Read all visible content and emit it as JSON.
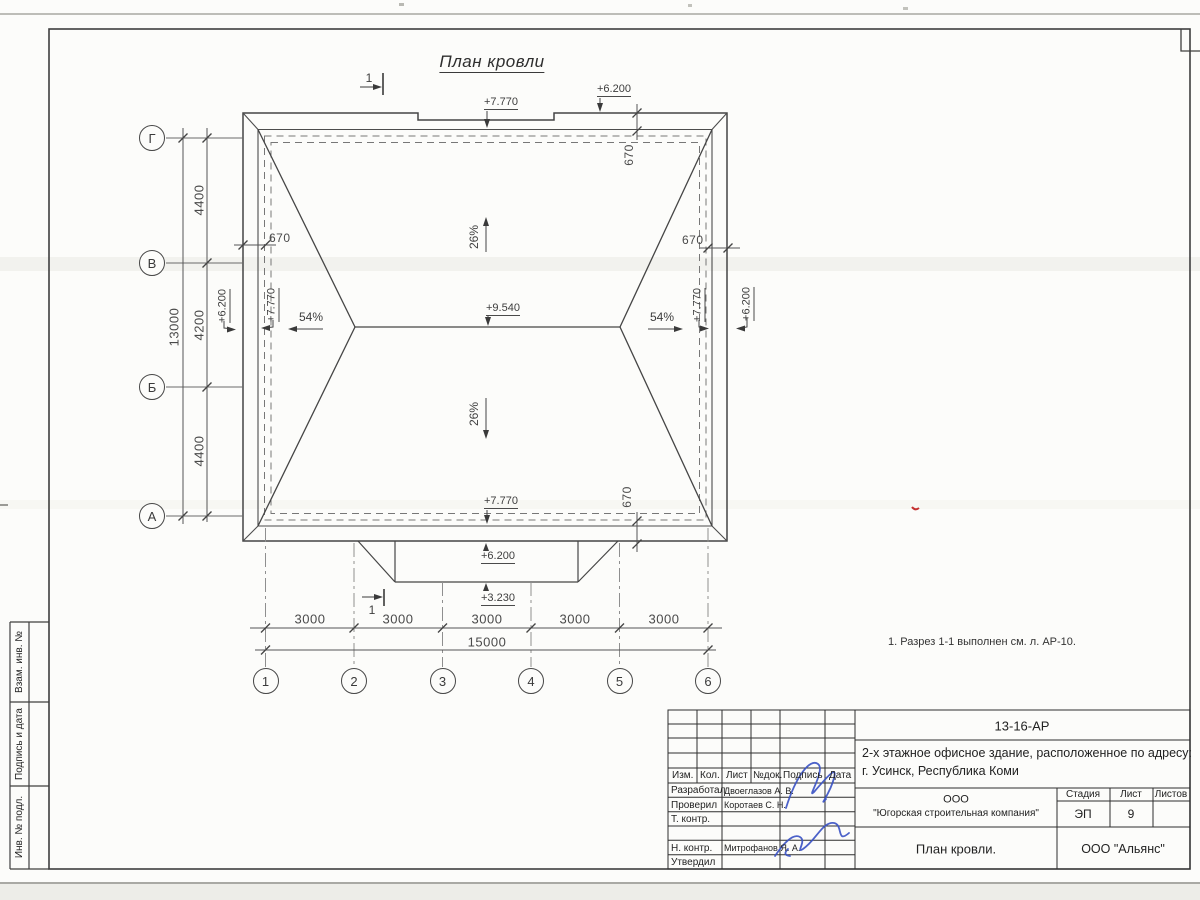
{
  "sheet": {
    "title": "План кровли",
    "note": "1. Разрез 1-1 выполнен см. л. АР-10.",
    "section_mark": "1"
  },
  "roof": {
    "slope_main": "26%",
    "slope_hip": "54%",
    "elev_ridge": "+9.540",
    "elev_parapet": "+7.770",
    "elev_wall": "+6.200",
    "elev_canopy": "+3.230",
    "parapet_width": "670"
  },
  "axes": {
    "horizontal": [
      "Г",
      "В",
      "Б",
      "А"
    ],
    "vertical": [
      "1",
      "2",
      "3",
      "4",
      "5",
      "6"
    ]
  },
  "dims": {
    "left_segments": [
      "4400",
      "4200",
      "4400"
    ],
    "left_total": "13000",
    "bottom_segments": [
      "3000",
      "3000",
      "3000",
      "3000",
      "3000"
    ],
    "bottom_total": "15000"
  },
  "stamp_side": [
    "Взам. инв. №",
    "Подпись и дата",
    "Инв. № подл."
  ],
  "title_block": {
    "doc_number": "13-16-АР",
    "object_line1": "2-х этажное офисное здание, расположенное по адресу:",
    "object_line2": "г. Усинск, Республика Коми",
    "company_line1": "ООО",
    "company_line2": "\"Югорская строительная компания\"",
    "stage_label": "Стадия",
    "sheet_label": "Лист",
    "sheets_label": "Листов",
    "stage": "ЭП",
    "sheet_no": "9",
    "sheets_total": "",
    "drawing_name": "План кровли.",
    "contractor": "ООО \"Альянс\"",
    "header": [
      "Изм.",
      "Кол.",
      "Лист",
      "№док.",
      "Подпись",
      "Дата"
    ],
    "rows": [
      {
        "role": "Разработал",
        "name": "Двоеглазов А. В."
      },
      {
        "role": "Проверил",
        "name": "Коротаев С. Н."
      },
      {
        "role": "Т. контр.",
        "name": ""
      },
      {
        "role": "Н. контр.",
        "name": "Митрофанов Я. А."
      },
      {
        "role": "Утвердил",
        "name": ""
      }
    ]
  }
}
